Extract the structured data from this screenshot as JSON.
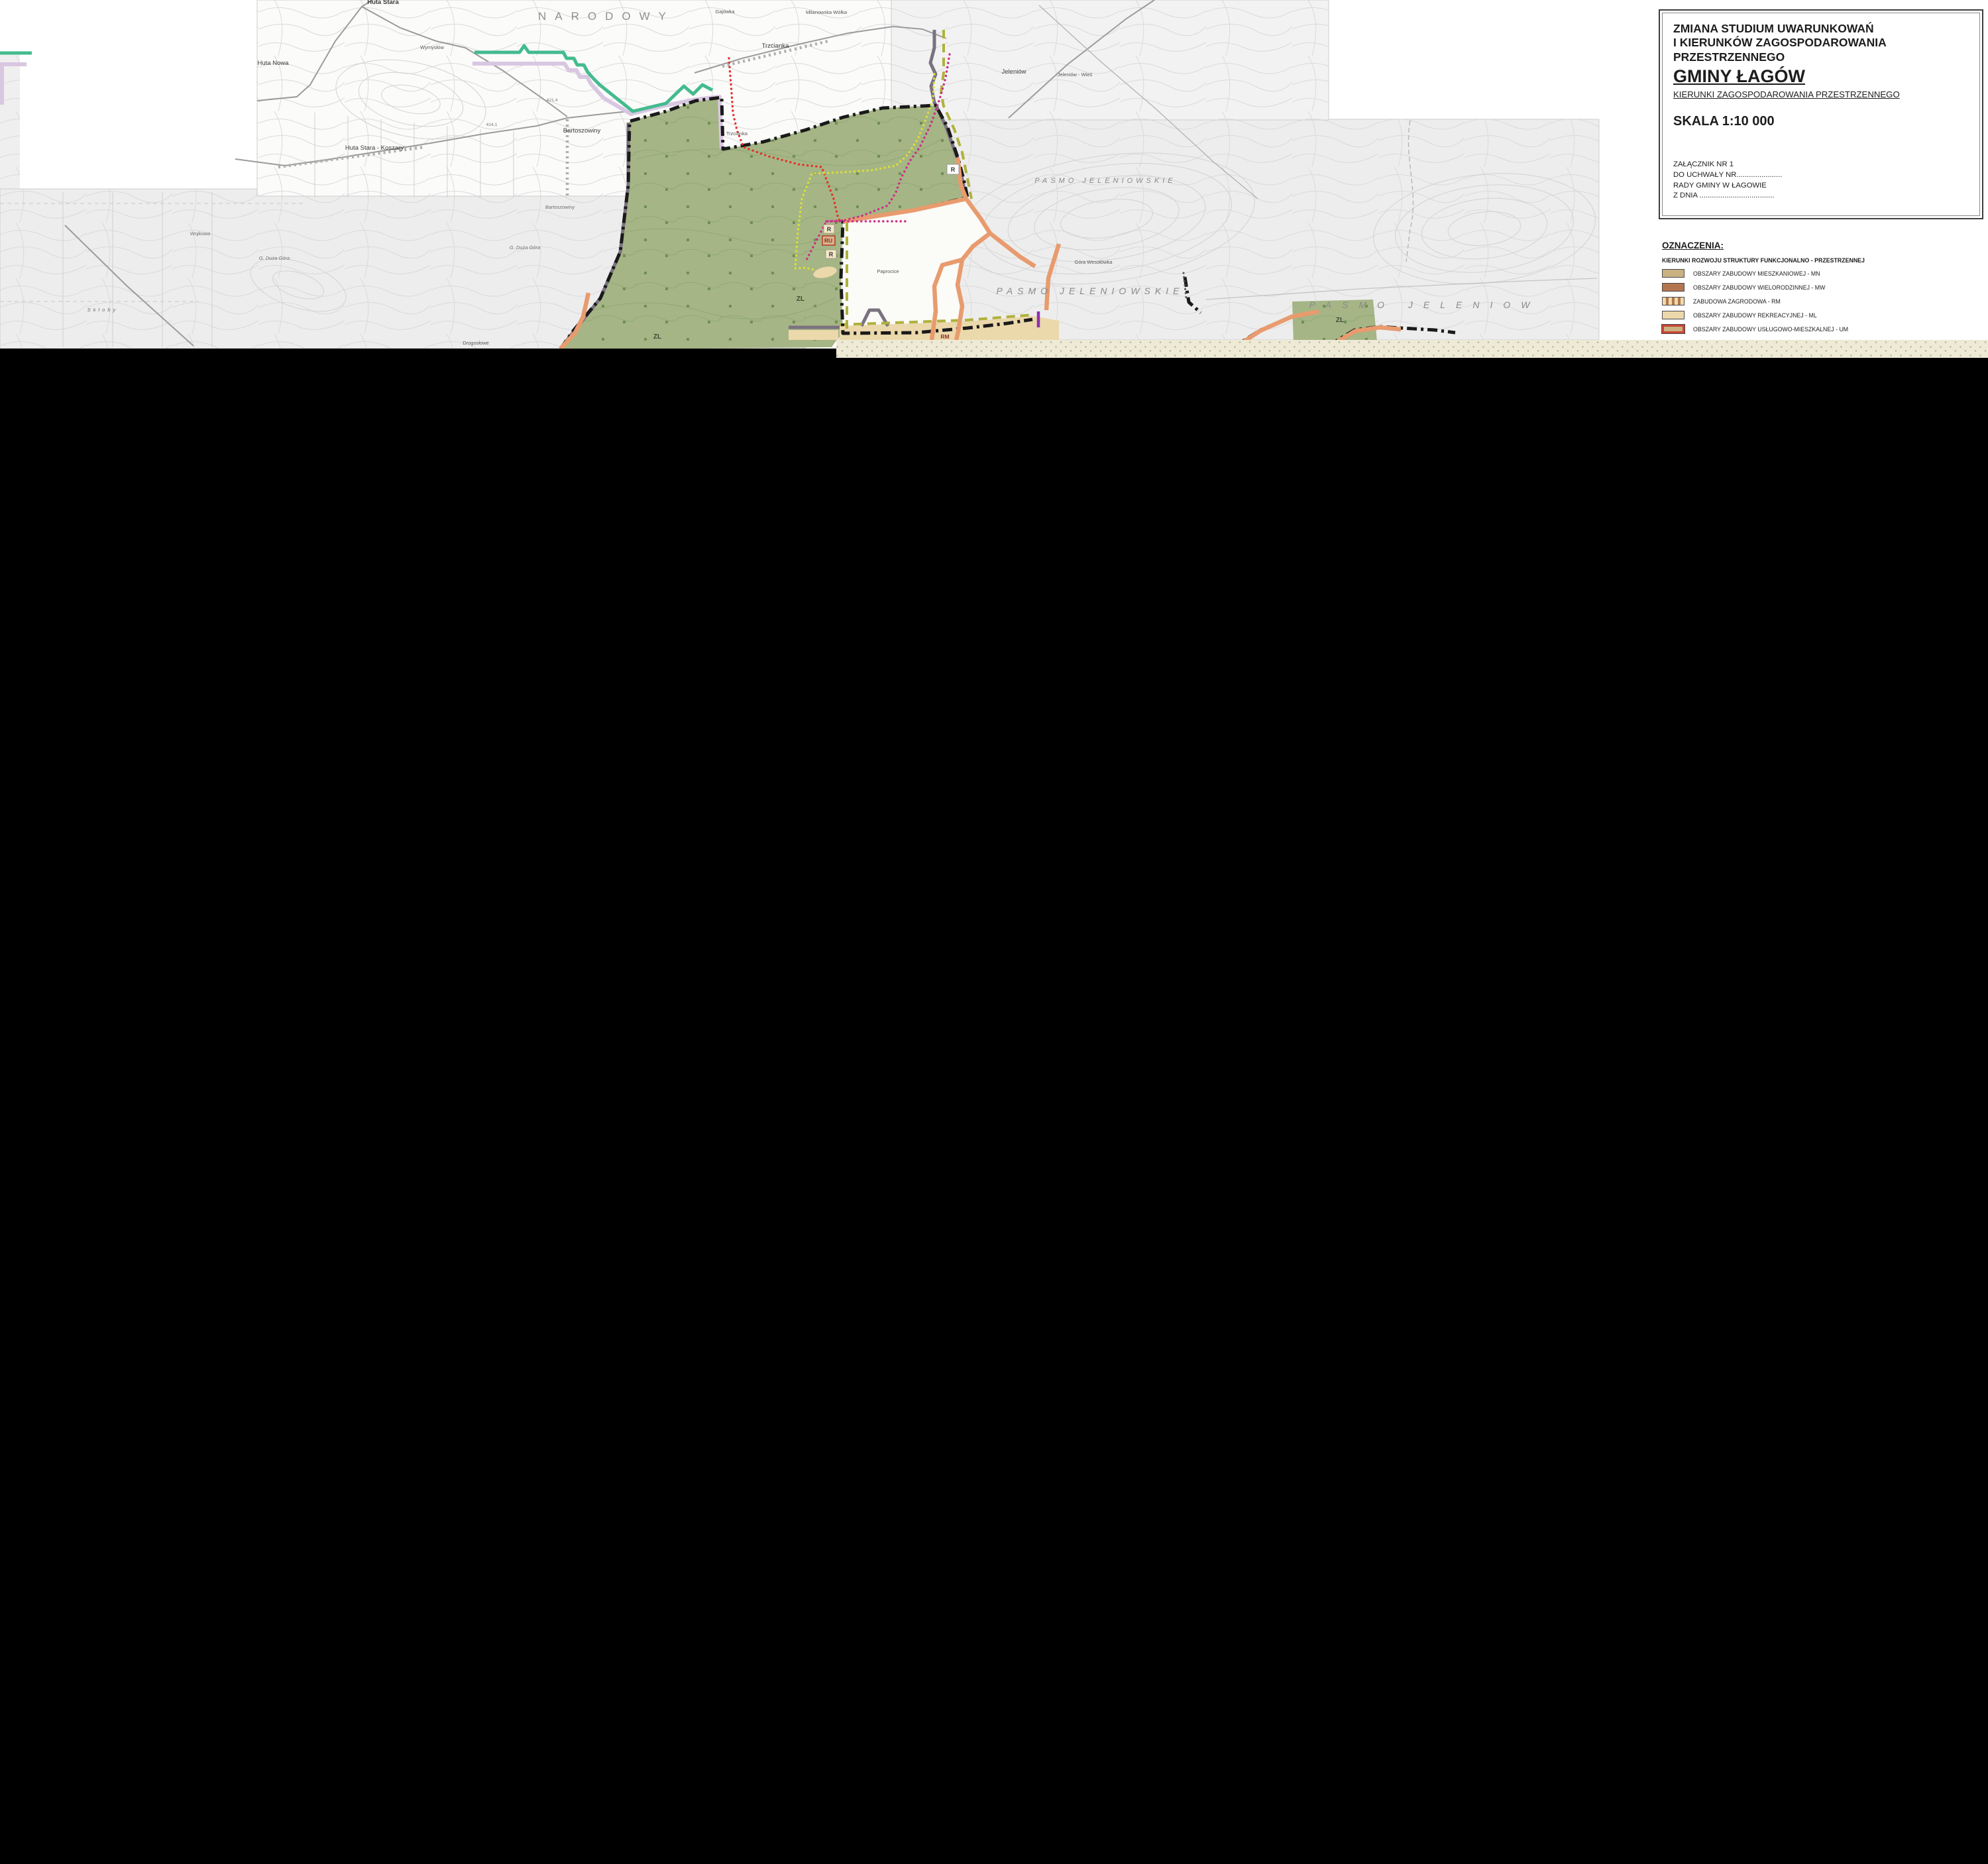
{
  "colors": {
    "park": "#a5b585",
    "trees": "#6f8f51",
    "contour": "#dadada",
    "mn": "#c9b182",
    "mw": "#b4764f",
    "rm_bg": "#eedcab",
    "ml": "#ebd8ab",
    "um_border": "#cb4336",
    "orange": "#e89b6e",
    "teal": "#43bb8e",
    "lavender": "#d9c7e2",
    "taupe": "#7b7280",
    "olive": "#b0b13c",
    "red": "#e3322d",
    "yellow": "#d9de3a",
    "magenta": "#cb2f88",
    "purple": "#8f2fae",
    "strip_bg": "#eeead6",
    "strip_dot": "#b3baa0",
    "boundary": "#1a1a1a"
  },
  "title_block": {
    "line1": "ZMIANA  STUDIUM  UWARUNKOWAŃ",
    "line2": "I KIERUNKÓW ZAGOSPODAROWANIA",
    "line3": "PRZESTRZENNEGO",
    "name": "GMINY ŁAGÓW",
    "subtitle": "KIERUNKI ZAGOSPODAROWANIA PRZESTRZENNEGO",
    "scale": "SKALA 1:10 000",
    "attachment_line1": "ZAŁĄCZNIK NR 1",
    "attachment_line2": "DO UCHWAŁY NR......................",
    "attachment_line3": "RADY GMINY W ŁAGOWIE",
    "attachment_line4": "Z DNIA ...................................."
  },
  "legend": {
    "heading": "OZNACZENIA:",
    "subheading": "KIERUNKI ROZWOJU STRUKTURY FUNKCJONALNO - PRZESTRZENNEJ",
    "items": [
      {
        "code": "MN",
        "label": "OBSZARY ZABUDOWY MIESZKANIOWEJ - MN"
      },
      {
        "code": "MW",
        "label": "OBSZARY ZABUDOWY WIELORODZINNEJ - MW"
      },
      {
        "code": "RM",
        "label": "ZABUDOWA ZAGRODOWA - RM"
      },
      {
        "code": "ML",
        "label": "OBSZARY ZABUDOWY REKREACYJNEJ - ML"
      },
      {
        "code": "UM",
        "label": "OBSZARY ZABUDOWY USŁUGOWO-MIESZKALNEJ - UM"
      }
    ]
  },
  "map": {
    "labels": [
      {
        "text": "NARODOWY"
      },
      {
        "text": "PASMO JELENIOWSKIE"
      },
      {
        "text": "PASMO JELENIOWSKIE"
      },
      {
        "text": "PASMO JELENIOW"
      },
      {
        "text": "Huta Nowa"
      },
      {
        "text": "Huta Stara - Koszary"
      },
      {
        "text": "Huta Stara"
      },
      {
        "text": "Wymysłów"
      },
      {
        "text": "Milanowska Wólka"
      },
      {
        "text": "Trzcianka"
      },
      {
        "text": "Trzcianka"
      },
      {
        "text": "Bartoszowiny"
      },
      {
        "text": "Bartoszowiny"
      },
      {
        "text": "Jeleniów"
      },
      {
        "text": "Jeleniów - Wieś"
      },
      {
        "text": "Gajówka"
      },
      {
        "text": "Paprocice"
      },
      {
        "text": "Drogosłowe"
      },
      {
        "text": "Wojkowa"
      },
      {
        "text": "G. Duża Góra"
      },
      {
        "text": "G. Duża Góra"
      },
      {
        "text": "Skłoby"
      },
      {
        "text": "Góra Wesołówka"
      },
      {
        "text": "ZL"
      },
      {
        "text": "ZL"
      },
      {
        "text": "ZL"
      },
      {
        "text": "R"
      },
      {
        "text": "R"
      },
      {
        "text": "RU"
      },
      {
        "text": "R"
      },
      {
        "text": "RM"
      },
      {
        "text": "421,4"
      },
      {
        "text": "414,1"
      }
    ]
  }
}
